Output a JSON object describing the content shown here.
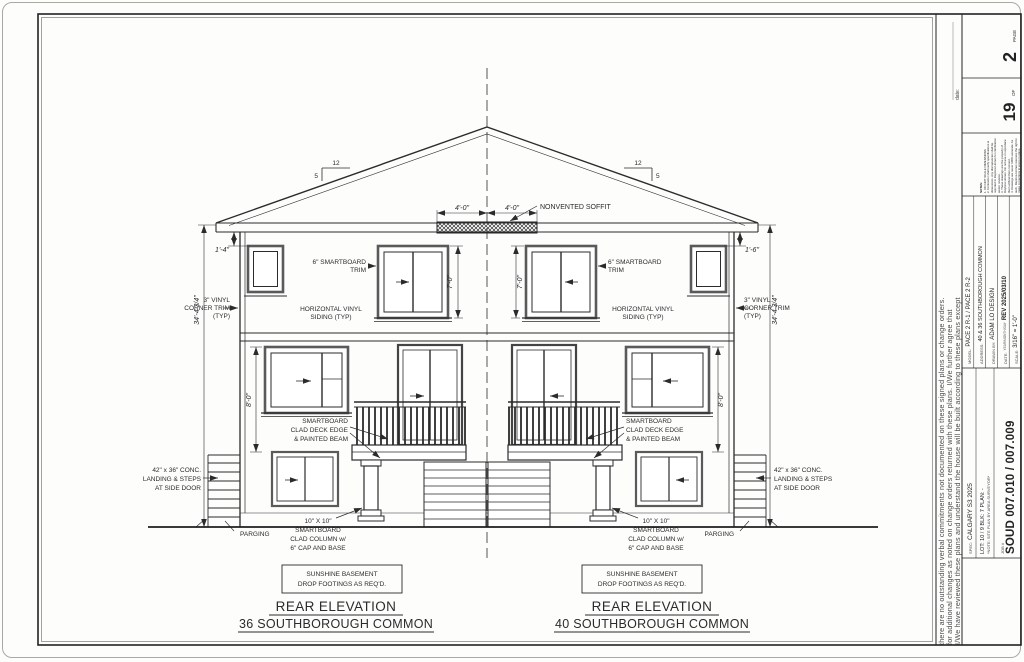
{
  "sheet": {
    "disclaimer": {
      "line1": "I/We have reviewed these plans and understand the house will be built according to these plans except",
      "line2": "for additional changes as noted on change orders returned with these plans. I/We further agree that",
      "line3": "there are no outstanding verbal commitments not documented on these signed plans or change orders.",
      "date_label": "date:"
    },
    "title_block": {
      "page_label": "PAGE",
      "page_number": "2",
      "of_label": "OF",
      "total_pages": "19",
      "notes_heading": "NOTES:",
      "note1": "1. DO NOT SCALE DIMENSIONS",
      "note2": "2. Contractor shall verify specifications & dimensions. Any discrepancies shall be reported to Daytona Homes for clarification and/or revision.",
      "note3": "3. These drawings are the property of Daytona Homes. Do not use or reproduce them without their consent.",
      "note4": "4. Drawings are never 100% accurate. As such, Daytona Homes reserves the right to make corrections to errors in plans.",
      "model_label": "MODEL:",
      "model": "PACE 2 R-1 / PACE 2 R-2",
      "address_label": "ADDRESS:",
      "address": "40 & 36 SOUTHBOROUGH COMMON",
      "drawn_by_label": "DRAWN BY:",
      "drawn_by": "ADAM LO DESIGN",
      "date_label": "DATE:",
      "date_format": "YEAR/MONTH/DAY",
      "date": "REV 2025/03/10",
      "scale_label": "SCALE:",
      "scale": "3/16\" = 1'-0\"",
      "job_label": "JOB #",
      "job_number": "SOUD 007.010 / 007.009",
      "lot_line": "LOT: 10 / 9   BLK: 7   PLAN: -",
      "site_note": "*NOTE: SITE PLAN BY AREA SURVEYOR*",
      "spec_label": "SPEC:",
      "spec": "CALGARY S3 2025"
    }
  },
  "drawing": {
    "elevation_left": {
      "title": "REAR ELEVATION",
      "subtitle": "36 SOUTHBOROUGH COMMON",
      "basement_note_1": "SUNSHINE BASEMENT",
      "basement_note_2": "DROP FOOTINGS AS REQ'D."
    },
    "elevation_right": {
      "title": "REAR ELEVATION",
      "subtitle": "40 SOUTHBOROUGH COMMON",
      "basement_note_1": "SUNSHINE BASEMENT",
      "basement_note_2": "DROP FOOTINGS AS REQ'D."
    },
    "labels": {
      "nonvented_soffit": "NONVENTED SOFFIT",
      "smartboard_trim_1": "6\" SMARTBOARD",
      "smartboard_trim_2": "TRIM",
      "siding_1": "HORIZONTAL VINYL",
      "siding_2": "SIDING (TYP)",
      "corner_trim_1": "3\" VINYL",
      "corner_trim_2": "CORNER TRIM",
      "corner_trim_3": "(TYP)",
      "deck_edge_1": "SMARTBOARD",
      "deck_edge_2": "CLAD DECK EDGE",
      "deck_edge_3": "& PAINTED BEAM",
      "landing_1": "42\" x 36\" CONC.",
      "landing_2": "LANDING & STEPS",
      "landing_3": "AT SIDE DOOR",
      "parging": "PARGING",
      "column_1": "10\" X 10\"",
      "column_2": "SMARTBOARD",
      "column_3": "CLAD COLUMN w/",
      "column_4": "6\" CAP AND BASE"
    },
    "dims": {
      "soffit_half_left": "4'-0\"",
      "soffit_half_right": "4'-0\"",
      "upper_window_height": "7'-0\"",
      "storey_height": "8'-0\"",
      "overall_height": "34'-4 3/4\"",
      "eave_to_window_left": "1'-4\"",
      "eave_to_window_right": "1'-6\"",
      "roof_run": "12",
      "roof_rise": "5"
    }
  }
}
